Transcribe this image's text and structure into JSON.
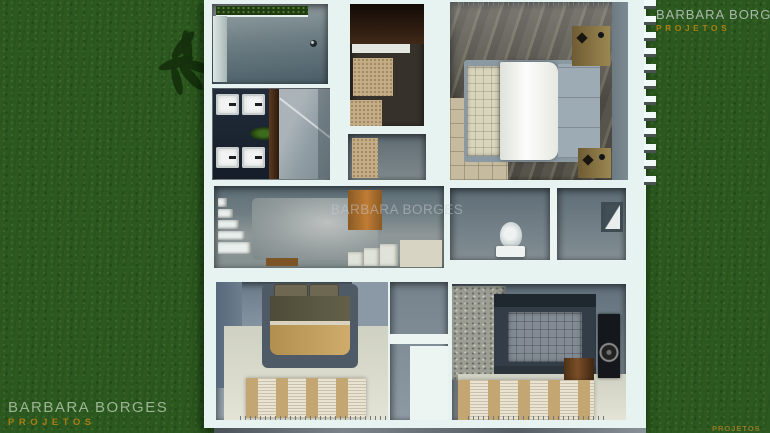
{
  "brand": {
    "name": "BARBARA BORGES",
    "tagline": "PROJETOS"
  },
  "watermarks": {
    "top_right": {
      "title": "BARBARA BORGES",
      "subtitle": "PROJETOS"
    },
    "center": {
      "title": "BARBARA BORGES"
    },
    "bottom_left": {
      "title": "BARBARA BORGES",
      "subtitle": "PROJETOS"
    },
    "bottom_right": {
      "subtitle": "PROJETOS"
    }
  },
  "colors": {
    "grass_green": "#2c591f",
    "wall_white": "#e7f3f1",
    "brand_orange": "#b9820f",
    "watermark_gray": "#b9c2bc"
  }
}
